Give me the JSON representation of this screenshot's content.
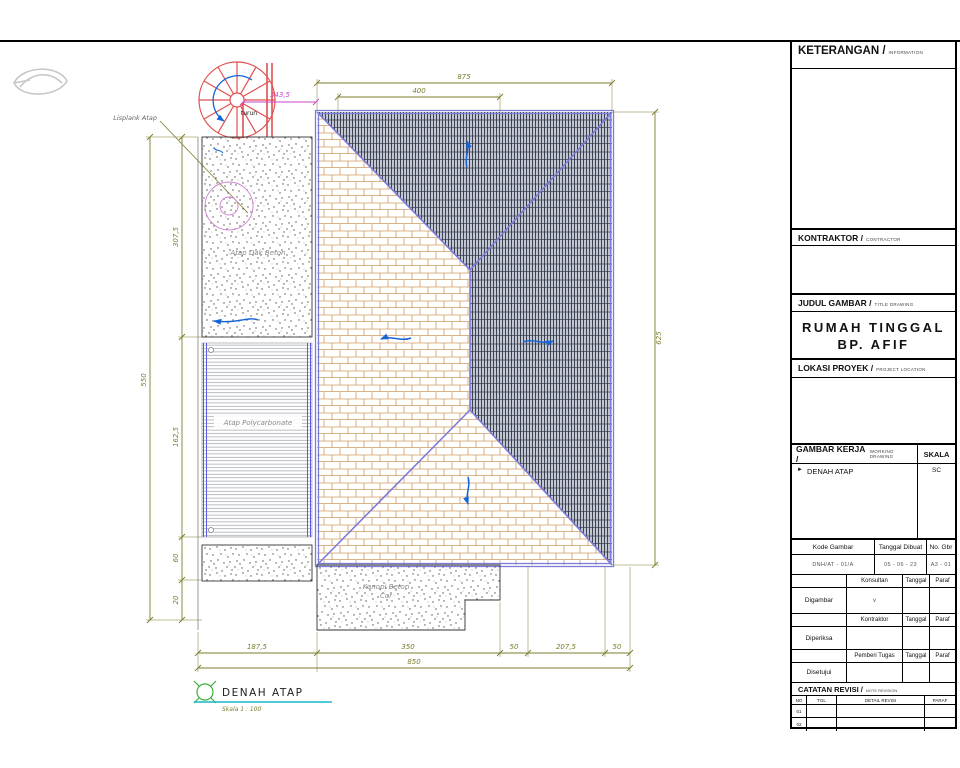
{
  "drawing": {
    "title": "DENAH ATAP",
    "subtitle": "Skala 1 : 100",
    "labels": {
      "turun": "turun",
      "lisplank": "Lisplank Atap",
      "dak": "Atap Dak Beton",
      "polycarbonate": "Atap Polycarbonate",
      "kanopi1": "Kanopi Beton",
      "kanopi2": "Cor"
    },
    "dims": {
      "top_outer": "875",
      "top_inner": "400",
      "stair": "343,5",
      "right_side": "625",
      "left_outer": "550",
      "left_col": [
        "307,5",
        "162,5",
        "60",
        "20"
      ],
      "bottom_segments": [
        "187,5",
        "350",
        "50",
        "207,5",
        "50"
      ],
      "bottom_total": "850"
    }
  },
  "titleblock": {
    "keterangan_label": "KETERANGAN /",
    "keterangan_sub": "INFORMATION",
    "kontraktor_label": "KONTRAKTOR /",
    "kontraktor_sub": "CONTRACTOR",
    "judul_label": "JUDUL GAMBAR /",
    "judul_sub": "TITLE DRAWING",
    "project_line1": "RUMAH TINGGAL",
    "project_line2": "BP. AFIF",
    "lokasi_label": "LOKASI PROYEK /",
    "lokasi_sub": "PROJECT LOCATION",
    "gambar_kerja_label": "GAMBAR KERJA /",
    "gambar_kerja_sub": "WORKING DRAWING",
    "skala": "SKALA",
    "sheet_bullet": "►",
    "sheet_name": "DENAH ATAP",
    "sheet_scale": "SC",
    "kode_headers": [
      "Kode Gambar",
      "Tanggal Dibuat",
      "No. Gbr"
    ],
    "kode_values": [
      "DNH/AT - 01/A",
      "05 - 06 - 23",
      "A3 - 01"
    ],
    "sign_rows": [
      {
        "left": "Digambar",
        "role": "Konsultan",
        "tgl": "Tanggal",
        "paraf": "Paraf",
        "mark": "v"
      },
      {
        "left": "Diperiksa",
        "role": "Kontraktor",
        "tgl": "Tanggal",
        "paraf": "Paraf",
        "mark": ""
      },
      {
        "left": "Disetujui",
        "role": "Pemberi Tugas",
        "tgl": "Tanggal",
        "paraf": "Paraf",
        "mark": ""
      }
    ],
    "catatan_label": "CATATAN REVISI /",
    "catatan_sub": "NOTE REVISION",
    "catatan_cols": [
      "NO",
      "TGL",
      "DETAIL REVISI",
      "PARAF"
    ],
    "catatan_rows": [
      "01",
      "02"
    ]
  }
}
